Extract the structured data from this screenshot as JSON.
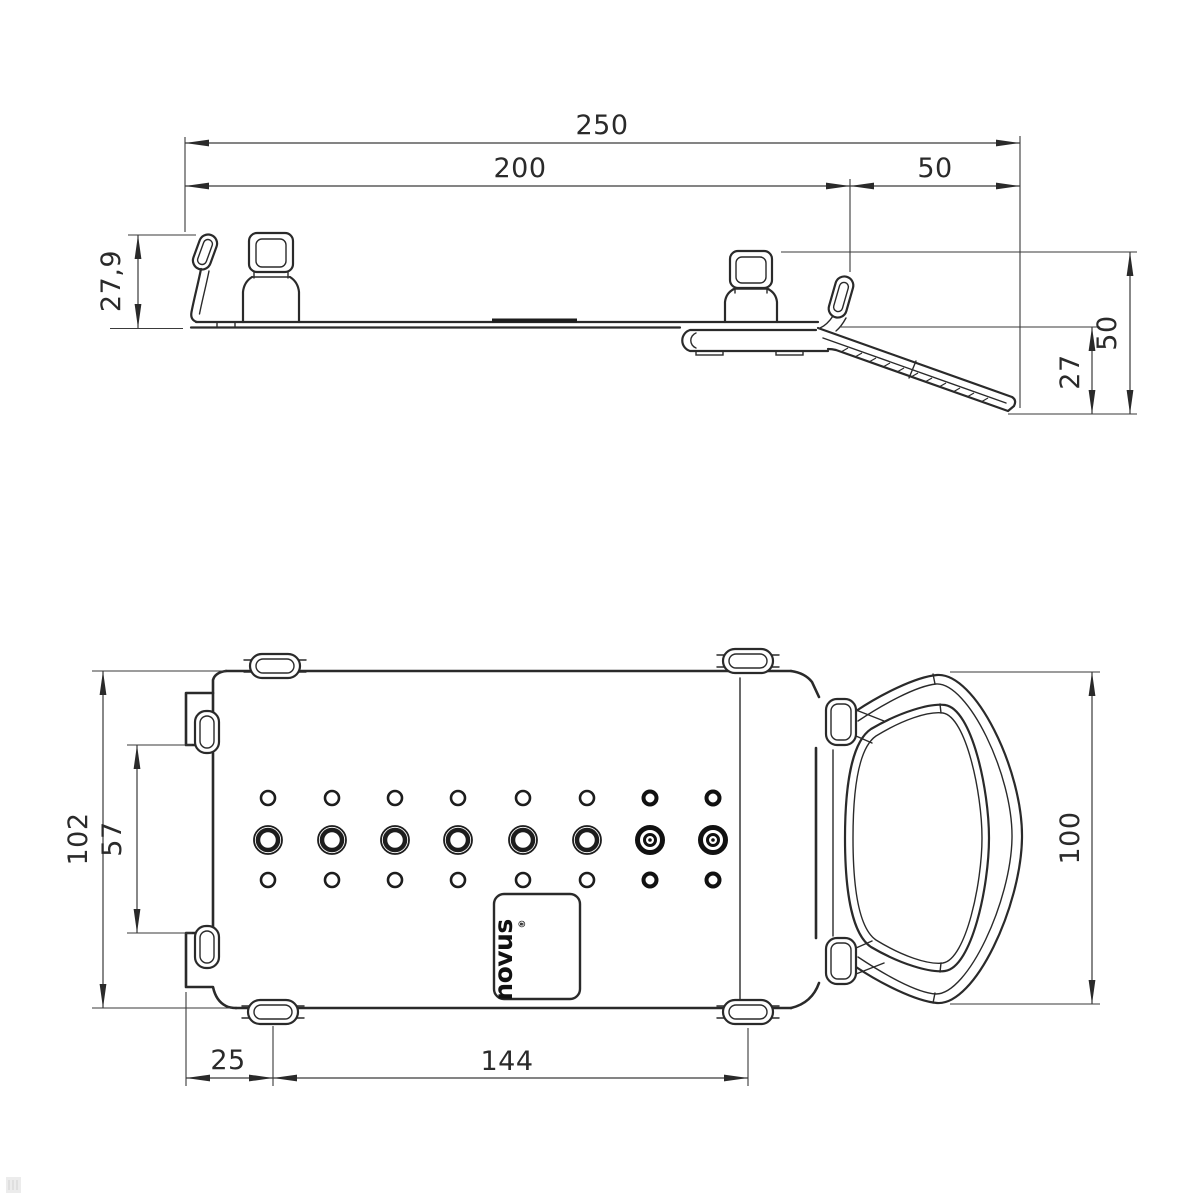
{
  "drawing": {
    "type": "technical-dimension-drawing",
    "background": "#ffffff",
    "line_color": "#2a2a2a",
    "watermark_color": "#ebebeb"
  },
  "side_view": {
    "dim_total_width": "250",
    "dim_plate_width": "200",
    "dim_hook_width": "50",
    "dim_stop_height": "27,9",
    "dim_drop_total": "50",
    "dim_drop_arm": "27"
  },
  "plan_view": {
    "dim_plate_height": "102",
    "dim_slot_height": "57",
    "dim_ring_height": "100",
    "dim_tab_offset": "25",
    "dim_tab_span": "144"
  },
  "logo": {
    "text": "novus",
    "registered": "®"
  }
}
